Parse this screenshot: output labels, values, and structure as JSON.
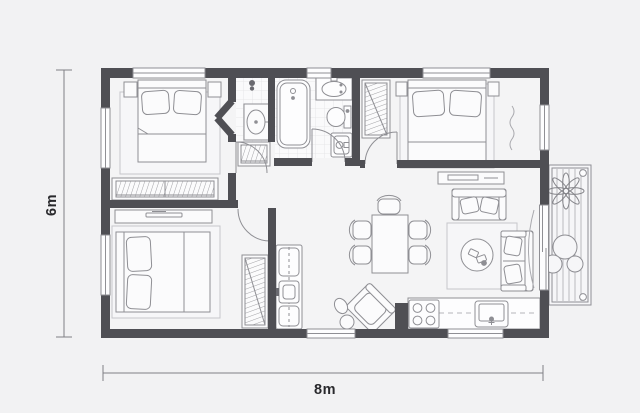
{
  "labels": {
    "height_dimension": "6m",
    "width_dimension": "8m"
  },
  "colors": {
    "background": "#f2f2f3",
    "walls": "#4f4f54",
    "furniture_outline": "#8f8f94",
    "furniture_fill": "#fbfbfc",
    "rug_outline": "#c6c6ca",
    "tile_line": "#e2e2e5",
    "dimension_line": "#808085",
    "label_text": "#29292c"
  },
  "plan": {
    "type": "apartment-floor-plan",
    "rooms": [
      "bedroom-top-left",
      "ensuite",
      "bathroom",
      "bedroom-top-right",
      "hallway",
      "bedroom-bottom-left",
      "living-dining",
      "kitchen",
      "balcony"
    ],
    "furniture": [
      "double-bed",
      "nightstand",
      "wardrobe",
      "dresser",
      "bathtub",
      "vanity-sink",
      "washbasin",
      "toilet",
      "washing-machine",
      "laundry-unit",
      "dining-table",
      "dining-chair",
      "armchair",
      "sideboard",
      "loveseat",
      "sofa",
      "coffee-table",
      "rug",
      "kitchen-counter",
      "stove",
      "kitchen-sink",
      "plant",
      "bushes",
      "curtain",
      "sliding-door",
      "window",
      "door"
    ]
  }
}
